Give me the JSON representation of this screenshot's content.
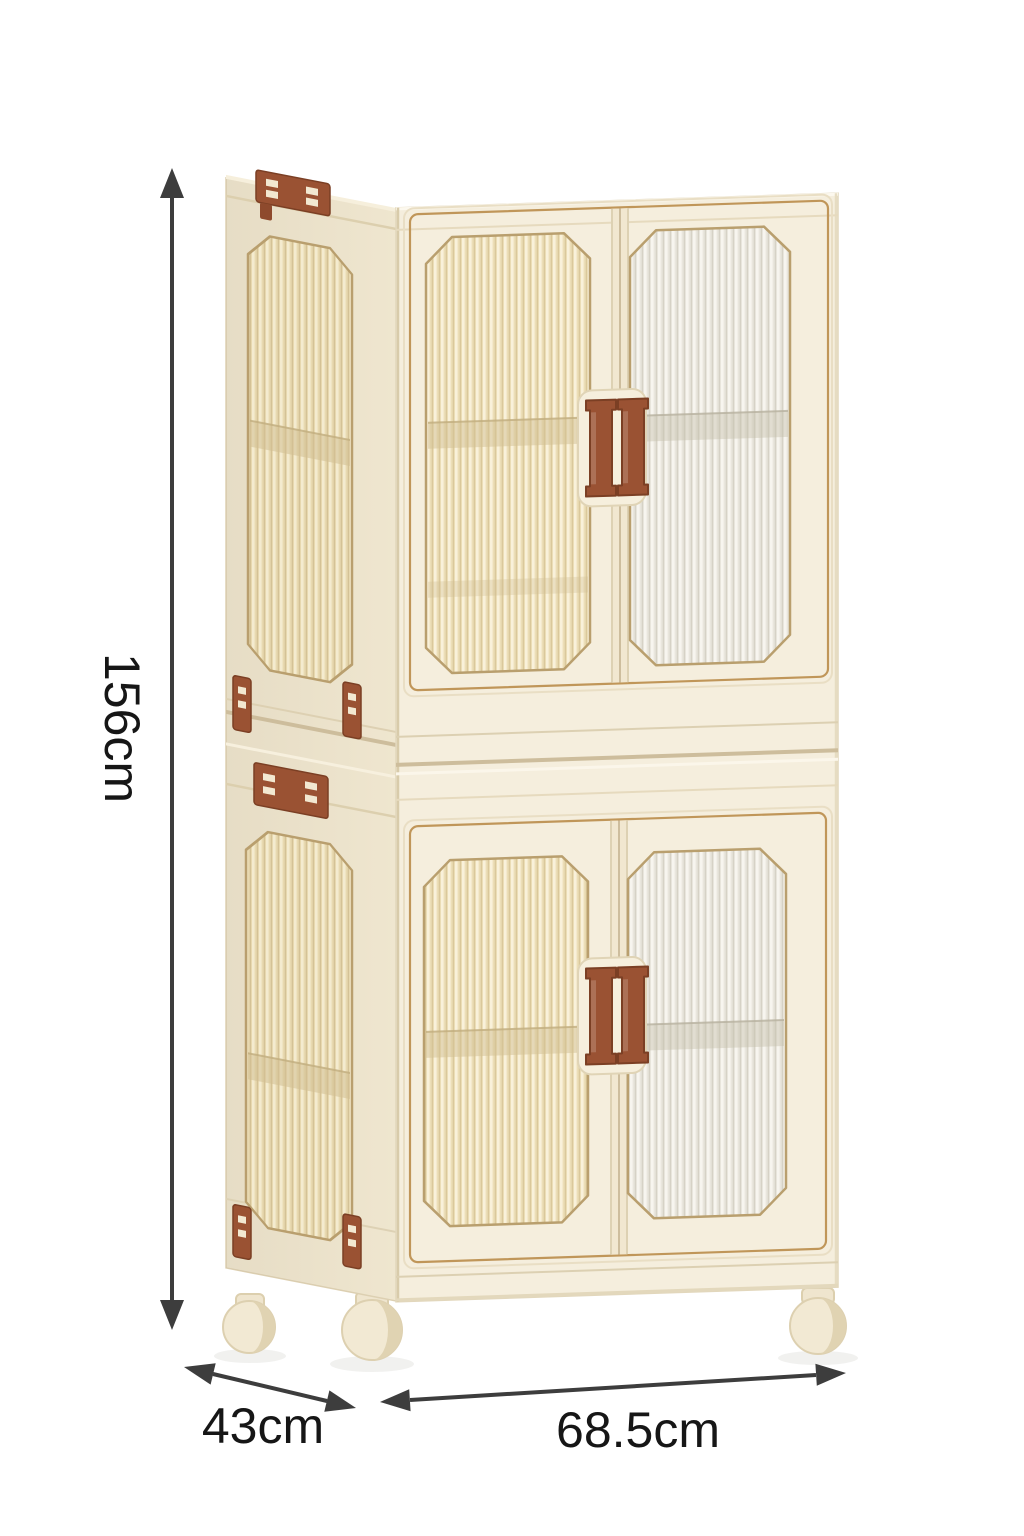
{
  "figure": {
    "type": "product-dimension-diagram",
    "product": "Two-tier foldable storage cabinet with fluted transparent doors, brown handles, brown latch clips and caster wheels"
  },
  "dimensions": {
    "height": {
      "label": "156cm",
      "axis": "vertical-left"
    },
    "depth": {
      "label": "43cm",
      "axis": "diagonal-bottom-left"
    },
    "width": {
      "label": "68.5cm",
      "axis": "horizontal-bottom"
    }
  },
  "icons": {
    "height_arrow": "double-headed-arrow-vertical",
    "depth_arrow": "double-headed-arrow-diagonal",
    "width_arrow": "double-headed-arrow-horizontal"
  },
  "palette": {
    "background": "#ffffff",
    "cabinet_body": "#f5eedd",
    "cabinet_side": "#efe6cf",
    "window_warm": "#ecdeb7",
    "window_cool": "#e9e6dd",
    "gold_trim": "#c09659",
    "hardware_brown": "#9a5233",
    "annotation_arrow": "#3d3d3d",
    "label_text": "#161616"
  }
}
